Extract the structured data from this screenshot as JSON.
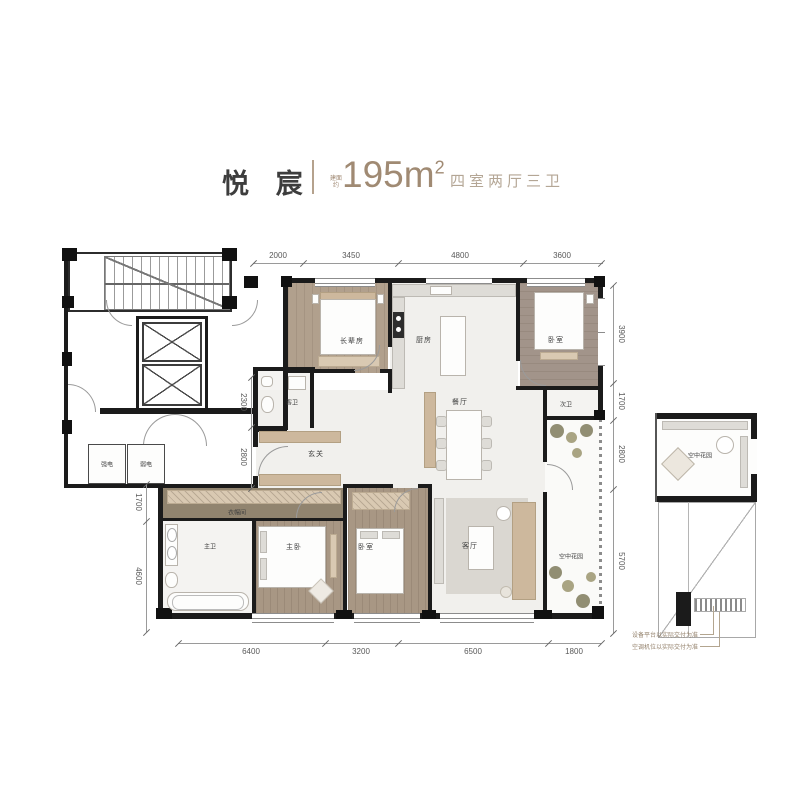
{
  "header": {
    "name": "悦 宸",
    "area_prefix_line1": "建面",
    "area_prefix_line2": "约",
    "area_value": "195m",
    "area_sup": "2",
    "spec": "四室两厅三卫"
  },
  "rooms": {
    "elder": "长辈房",
    "kitchen": "厨房",
    "bedroom_top": "卧室",
    "bath2": "次卫",
    "guest_bath": "客卫",
    "foyer": "玄关",
    "dining": "餐厅",
    "garden_strip": "空中花园",
    "closet": "衣帽间",
    "master_bath": "主卫",
    "master": "主卧",
    "bedroom2": "卧室",
    "living": "客厅",
    "garden_box": "空中花园",
    "elec_strong": "强电",
    "elec_weak": "弱电"
  },
  "dimensions": {
    "top": [
      "2000",
      "3450",
      "4800",
      "3600"
    ],
    "right": [
      "3900",
      "1700",
      "2800",
      "5700"
    ],
    "bottom": [
      "6400",
      "3200",
      "6500",
      "1800"
    ],
    "left": [
      "1700",
      "4600"
    ],
    "inner": [
      "2300",
      "2800"
    ]
  },
  "notes": [
    "设备平台以实际交付为准",
    "空调机位以实际交付为准"
  ]
}
